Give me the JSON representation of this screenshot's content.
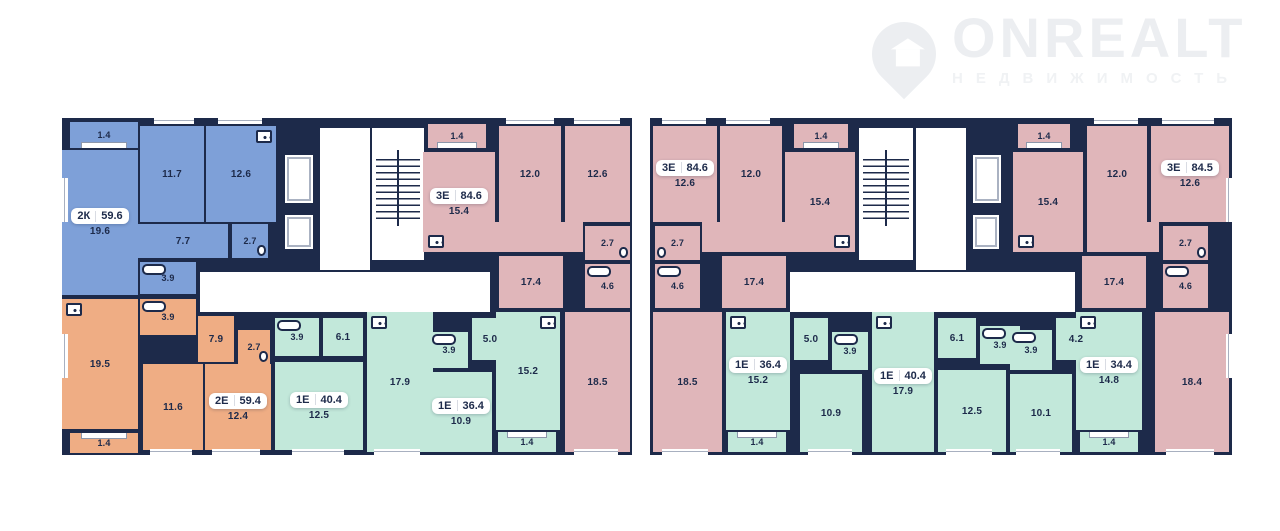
{
  "logo": {
    "brand": "ONREALT",
    "subtitle": "НЕДВИЖИМОСТЬ"
  },
  "colors": {
    "wall": "#1d2a4a",
    "blue": "#7ea0d8",
    "orange": "#efad84",
    "pink": "#e0b6ba",
    "green": "#c2e8da",
    "floor_white": "#ffffff",
    "label_text": "#1d2a4a",
    "logo_gray": "#eceef1"
  },
  "sections": [
    {
      "apartments": [
        {
          "type": "2К",
          "area": "59.6",
          "rooms": {
            "balcony": "1.4",
            "living": "19.6",
            "bedroom1": "11.7",
            "kitchen": "12.6",
            "hall": "7.7",
            "wc": "2.7",
            "bath": "3.9"
          }
        },
        {
          "type": "2Е",
          "area": "59.4",
          "rooms": {
            "living": "19.5",
            "balcony": "1.4",
            "bath": "3.9",
            "hall": "7.9",
            "wc": "2.7",
            "bedroom1": "11.6",
            "bedroom2": "12.4"
          }
        },
        {
          "type": "3Е",
          "area": "84.6",
          "rooms": {
            "balcony": "1.4",
            "living": "15.4",
            "bedroom1": "12.0",
            "bedroom2": "12.6",
            "kitchen": "17.4",
            "wc": "2.7",
            "bath": "4.6",
            "bedroom3": "18.5"
          }
        },
        {
          "type": "1Е",
          "area": "40.4",
          "rooms": {
            "bath": "3.9",
            "hall": "6.1",
            "living": "17.9",
            "bedroom1": "12.5"
          }
        },
        {
          "type": "1Е",
          "area": "36.4",
          "rooms": {
            "bath": "3.9",
            "hall": "5.0",
            "bedroom1": "10.9",
            "living": "15.2",
            "balcony": "1.4"
          }
        }
      ]
    },
    {
      "apartments": [
        {
          "type": "3Е",
          "area": "84.6",
          "rooms": {
            "bedroom1": "12.6",
            "bedroom2": "12.0",
            "balcony": "1.4",
            "living": "15.4",
            "wc": "2.7",
            "bath": "4.6",
            "kitchen": "17.4",
            "bedroom3": "18.5"
          }
        },
        {
          "type": "1Е",
          "area": "36.4",
          "rooms": {
            "living": "15.2",
            "balcony": "1.4",
            "hall": "5.0",
            "bath": "3.9",
            "bedroom1": "10.9"
          }
        },
        {
          "type": "1Е",
          "area": "40.4",
          "rooms": {
            "living": "17.9",
            "hall": "6.1",
            "bath": "3.9",
            "bedroom1": "12.5"
          }
        },
        {
          "type": "1Е",
          "area": "34.4",
          "rooms": {
            "bath": "3.9",
            "hall": "4.2",
            "bedroom1": "10.1",
            "living": "14.8",
            "balcony": "1.4"
          }
        },
        {
          "type": "3Е",
          "area": "84.5",
          "rooms": {
            "balcony": "1.4",
            "living": "15.4",
            "bedroom1": "12.0",
            "bedroom2": "12.6",
            "wc": "2.7",
            "bath": "4.6",
            "kitchen": "17.4",
            "bedroom3": "18.4"
          }
        }
      ]
    }
  ]
}
